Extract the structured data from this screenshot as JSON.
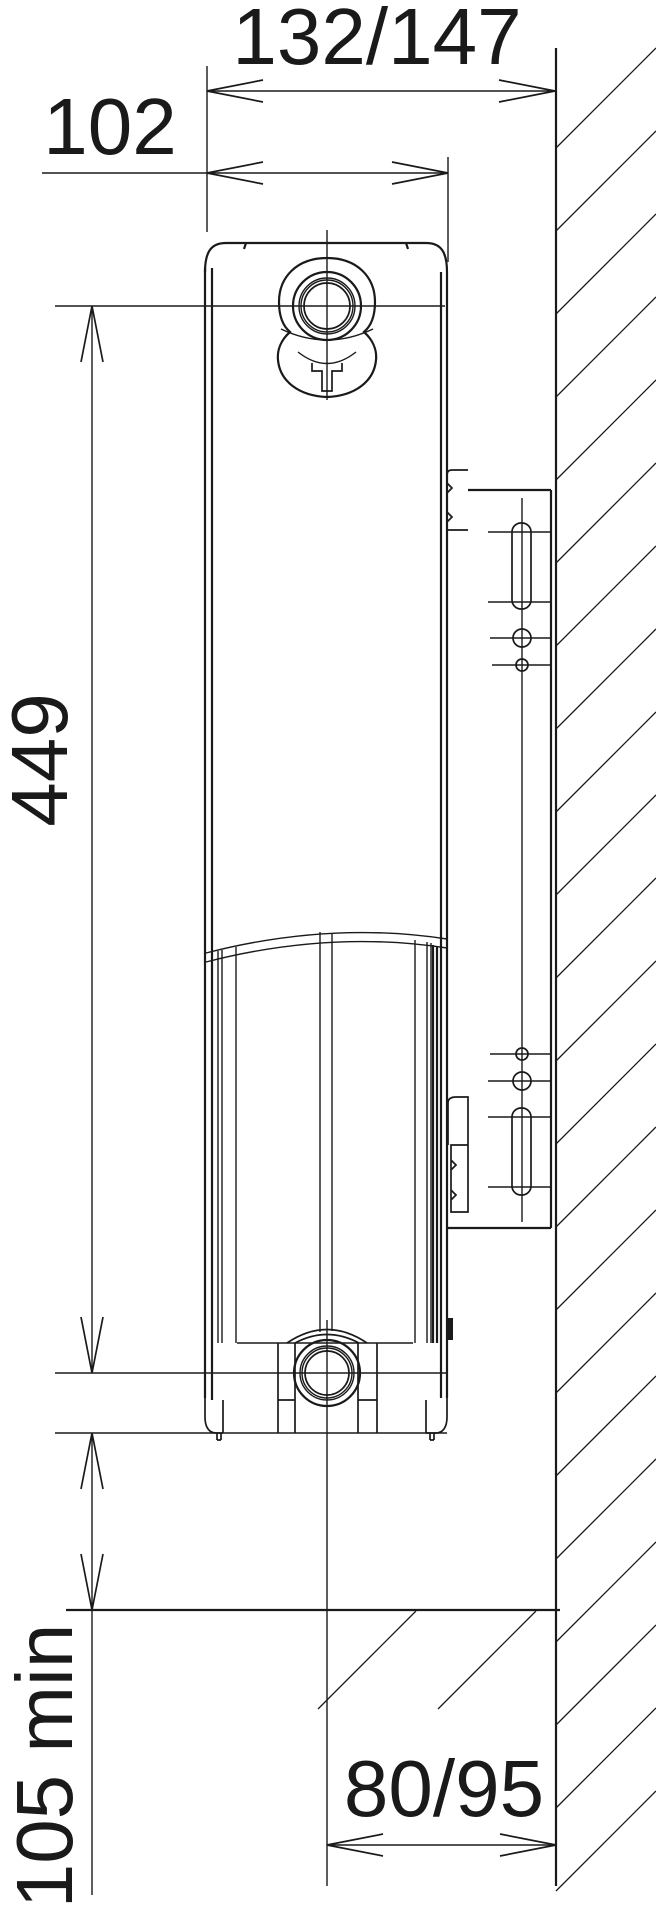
{
  "drawing": {
    "kind": "radiator side-view installation drawing",
    "dimensions": {
      "overall_depth_label": "132/147",
      "panel_depth_label": "102",
      "connection_spacing_label": "449",
      "floor_clearance_label": "105 min",
      "wall_to_pipe_label": "80/95"
    },
    "colors": {
      "line": "#1a1a1a",
      "background": "#ffffff"
    }
  }
}
